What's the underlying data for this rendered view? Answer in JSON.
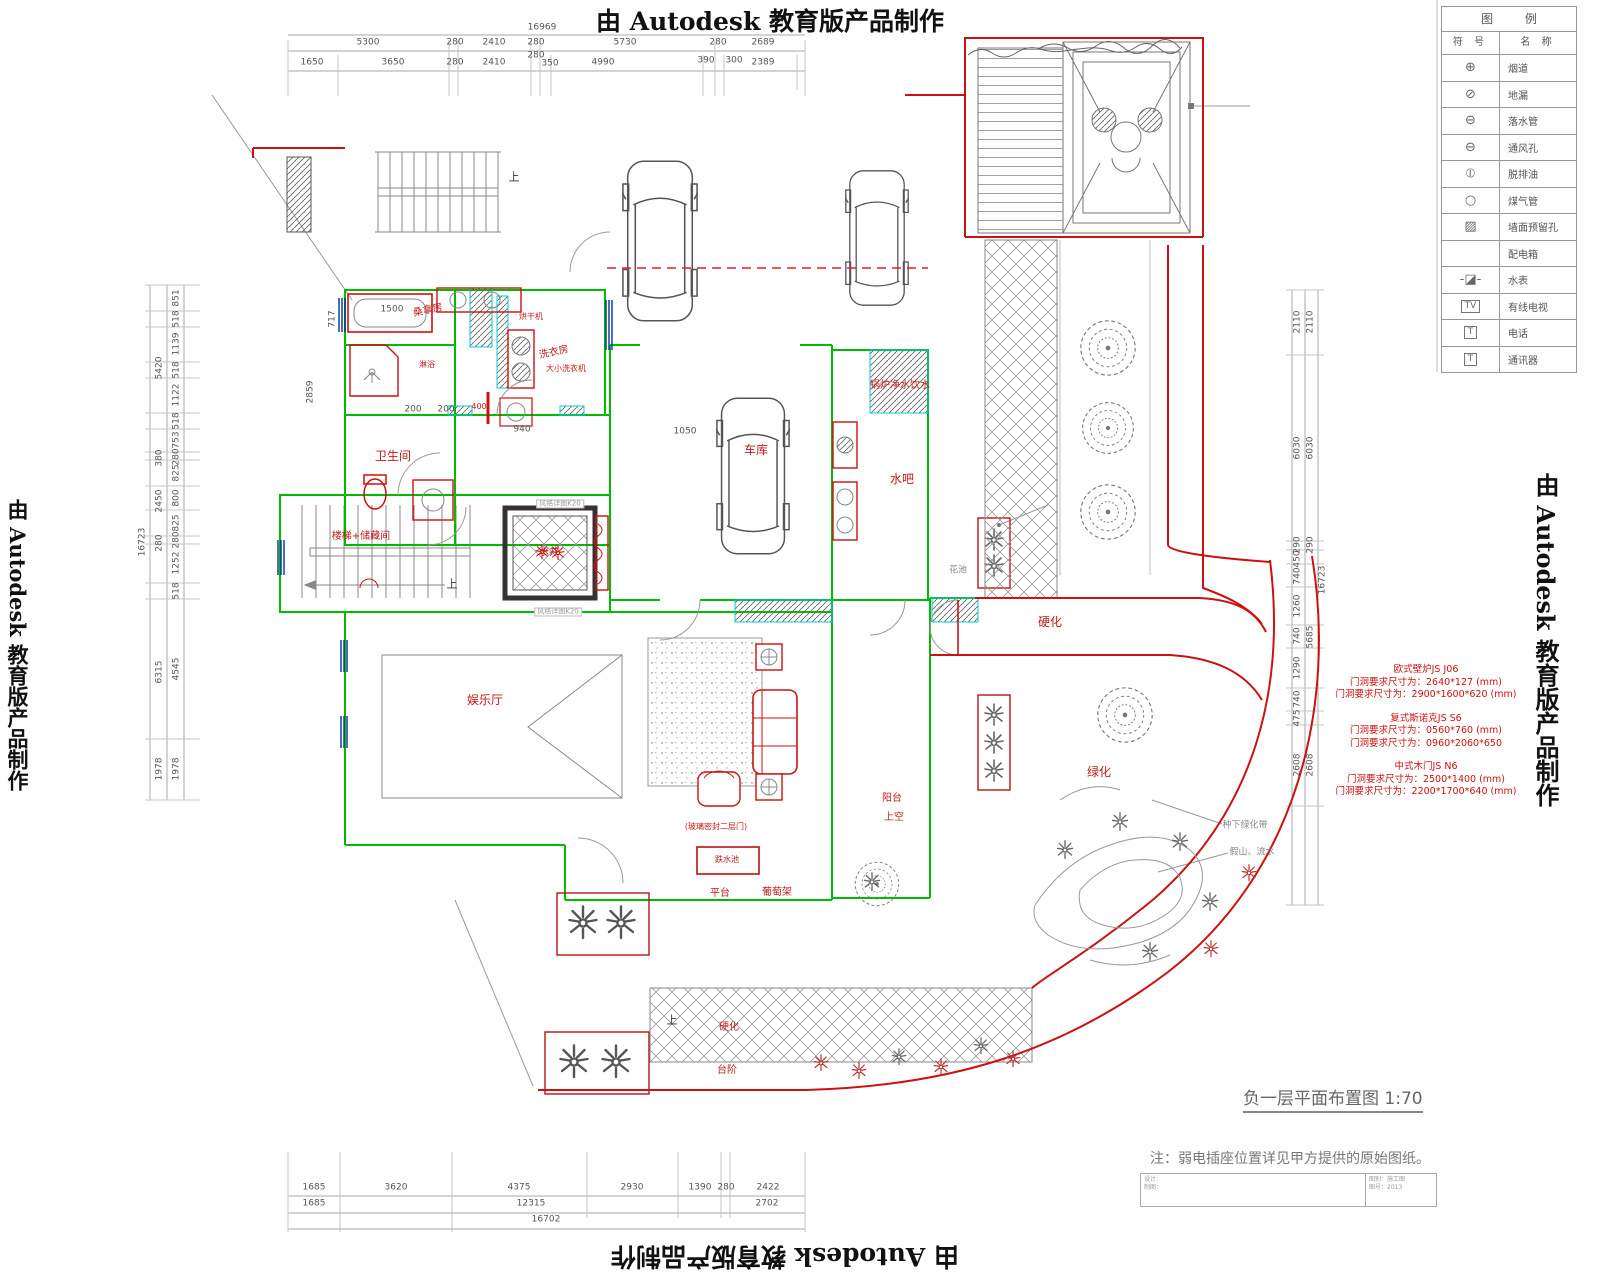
{
  "watermark": {
    "text": "由 Autodesk 教育版产品制作"
  },
  "title": {
    "text": "负一层平面布置图 1:70"
  },
  "note": {
    "text": "注：弱电插座位置详见甲方提供的原始图纸。"
  },
  "titleblock": {
    "left1": "设计：",
    "left2": "制图：",
    "right1": "图别：施工图",
    "right2": "图号：2013"
  },
  "legend": {
    "header": "图 例",
    "col_symbol": "符 号",
    "col_name": "名 称",
    "rows": [
      {
        "sym": "⊕",
        "name": "烟道",
        "box": false
      },
      {
        "sym": "⊘",
        "name": "地漏",
        "box": false
      },
      {
        "sym": "⊖",
        "name": "落水管",
        "box": false
      },
      {
        "sym": "⊖",
        "name": "通风孔",
        "box": false
      },
      {
        "sym": "⦶",
        "name": "脱排油",
        "box": false
      },
      {
        "sym": "○",
        "name": "煤气管",
        "box": false
      },
      {
        "sym": "▨",
        "name": "墙面预留孔",
        "box": false
      },
      {
        "sym": "",
        "name": "配电箱",
        "box": false
      },
      {
        "sym": "-◪-",
        "name": "水表",
        "box": false
      },
      {
        "sym": "TV",
        "name": "有线电视",
        "box": true
      },
      {
        "sym": "T",
        "name": "电话",
        "box": true
      },
      {
        "sym": "T",
        "name": "通讯器",
        "box": true
      }
    ]
  },
  "annotations": {
    "groups": [
      {
        "lines": [
          "欧式壁炉JS J06",
          "门洞要求尺寸为：2640*127 (mm)",
          "门洞要求尺寸为：2900*1600*620 (mm)"
        ]
      },
      {
        "lines": [
          "复式斯诺克JS S6",
          "门洞要求尺寸为：0560*760 (mm)",
          "门洞要求尺寸为：0960*2060*650"
        ]
      },
      {
        "lines": [
          "中式木门JS N6",
          "门洞要求尺寸为：2500*1400 (mm)",
          "门洞要求尺寸为：2200*1700*640 (mm)"
        ]
      }
    ]
  },
  "labels": [
    {
      "t": "16969",
      "x": 542,
      "y": 28,
      "c": "dim",
      "n": "dim-top-overall"
    },
    {
      "t": "5300",
      "x": 368,
      "y": 43,
      "c": "dim"
    },
    {
      "t": "280",
      "x": 455,
      "y": 43,
      "c": "dim"
    },
    {
      "t": "2410",
      "x": 494,
      "y": 43,
      "c": "dim"
    },
    {
      "t": "280",
      "x": 536,
      "y": 43,
      "c": "dim"
    },
    {
      "t": "5730",
      "x": 625,
      "y": 43,
      "c": "dim"
    },
    {
      "t": "280",
      "x": 718,
      "y": 43,
      "c": "dim"
    },
    {
      "t": "2689",
      "x": 763,
      "y": 43,
      "c": "dim"
    },
    {
      "t": "1650",
      "x": 312,
      "y": 63,
      "c": "dim"
    },
    {
      "t": "3650",
      "x": 393,
      "y": 63,
      "c": "dim"
    },
    {
      "t": "280",
      "x": 455,
      "y": 63,
      "c": "dim"
    },
    {
      "t": "2410",
      "x": 494,
      "y": 63,
      "c": "dim"
    },
    {
      "t": "280",
      "x": 536,
      "y": 56,
      "c": "dim"
    },
    {
      "t": "350",
      "x": 550,
      "y": 64,
      "c": "dim"
    },
    {
      "t": "4990",
      "x": 603,
      "y": 63,
      "c": "dim"
    },
    {
      "t": "390",
      "x": 706,
      "y": 61,
      "c": "dim"
    },
    {
      "t": "300",
      "x": 734,
      "y": 61,
      "c": "dim"
    },
    {
      "t": "2389",
      "x": 763,
      "y": 63,
      "c": "dim"
    },
    {
      "t": "1685",
      "x": 314,
      "y": 1188,
      "c": "dim"
    },
    {
      "t": "3620",
      "x": 396,
      "y": 1188,
      "c": "dim"
    },
    {
      "t": "4375",
      "x": 519,
      "y": 1188,
      "c": "dim"
    },
    {
      "t": "2930",
      "x": 632,
      "y": 1188,
      "c": "dim"
    },
    {
      "t": "1390",
      "x": 700,
      "y": 1188,
      "c": "dim"
    },
    {
      "t": "280",
      "x": 726,
      "y": 1188,
      "c": "dim"
    },
    {
      "t": "2422",
      "x": 768,
      "y": 1188,
      "c": "dim"
    },
    {
      "t": "1685",
      "x": 314,
      "y": 1204,
      "c": "dim"
    },
    {
      "t": "12315",
      "x": 531,
      "y": 1204,
      "c": "dim"
    },
    {
      "t": "2702",
      "x": 767,
      "y": 1204,
      "c": "dim"
    },
    {
      "t": "16702",
      "x": 546,
      "y": 1220,
      "c": "dim",
      "n": "dim-bottom-overall"
    },
    {
      "t": "851",
      "x": 177,
      "y": 298,
      "c": "dimv"
    },
    {
      "t": "518",
      "x": 177,
      "y": 319,
      "c": "dimv"
    },
    {
      "t": "1139",
      "x": 177,
      "y": 344,
      "c": "dimv"
    },
    {
      "t": "518",
      "x": 177,
      "y": 370,
      "c": "dimv"
    },
    {
      "t": "1122",
      "x": 177,
      "y": 395,
      "c": "dimv"
    },
    {
      "t": "518",
      "x": 177,
      "y": 421,
      "c": "dimv"
    },
    {
      "t": "753",
      "x": 177,
      "y": 440,
      "c": "dimv"
    },
    {
      "t": "280",
      "x": 177,
      "y": 457,
      "c": "dimv"
    },
    {
      "t": "825",
      "x": 177,
      "y": 473,
      "c": "dimv"
    },
    {
      "t": "800",
      "x": 177,
      "y": 498,
      "c": "dimv"
    },
    {
      "t": "825",
      "x": 177,
      "y": 523,
      "c": "dimv"
    },
    {
      "t": "280",
      "x": 177,
      "y": 540,
      "c": "dimv"
    },
    {
      "t": "1252",
      "x": 177,
      "y": 563,
      "c": "dimv"
    },
    {
      "t": "518",
      "x": 177,
      "y": 591,
      "c": "dimv"
    },
    {
      "t": "4545",
      "x": 177,
      "y": 669,
      "c": "dimv"
    },
    {
      "t": "1978",
      "x": 177,
      "y": 769,
      "c": "dimv"
    },
    {
      "t": "5420",
      "x": 160,
      "y": 368,
      "c": "dimv"
    },
    {
      "t": "380",
      "x": 160,
      "y": 458,
      "c": "dimv"
    },
    {
      "t": "2450",
      "x": 160,
      "y": 501,
      "c": "dimv"
    },
    {
      "t": "280",
      "x": 160,
      "y": 543,
      "c": "dimv"
    },
    {
      "t": "6315",
      "x": 160,
      "y": 672,
      "c": "dimv"
    },
    {
      "t": "1978",
      "x": 160,
      "y": 769,
      "c": "dimv"
    },
    {
      "t": "16723",
      "x": 143,
      "y": 542,
      "c": "dimv",
      "n": "dim-left-overall"
    },
    {
      "t": "2110",
      "x": 1298,
      "y": 322,
      "c": "dimv"
    },
    {
      "t": "6030",
      "x": 1298,
      "y": 448,
      "c": "dimv"
    },
    {
      "t": "290",
      "x": 1298,
      "y": 545,
      "c": "dimv"
    },
    {
      "t": "450",
      "x": 1298,
      "y": 559,
      "c": "dimv"
    },
    {
      "t": "740",
      "x": 1298,
      "y": 576,
      "c": "dimv"
    },
    {
      "t": "1260",
      "x": 1298,
      "y": 606,
      "c": "dimv"
    },
    {
      "t": "740",
      "x": 1298,
      "y": 636,
      "c": "dimv"
    },
    {
      "t": "1290",
      "x": 1298,
      "y": 668,
      "c": "dimv"
    },
    {
      "t": "740",
      "x": 1298,
      "y": 699,
      "c": "dimv"
    },
    {
      "t": "475",
      "x": 1298,
      "y": 718,
      "c": "dimv"
    },
    {
      "t": "2608",
      "x": 1298,
      "y": 765,
      "c": "dimv"
    },
    {
      "t": "2110",
      "x": 1311,
      "y": 322,
      "c": "dimv"
    },
    {
      "t": "6030",
      "x": 1311,
      "y": 448,
      "c": "dimv"
    },
    {
      "t": "290",
      "x": 1311,
      "y": 545,
      "c": "dimv"
    },
    {
      "t": "5685",
      "x": 1311,
      "y": 637,
      "c": "dimv"
    },
    {
      "t": "2608",
      "x": 1311,
      "y": 765,
      "c": "dimv"
    },
    {
      "t": "16723",
      "x": 1323,
      "y": 580,
      "c": "dimv",
      "n": "dim-right-overall"
    },
    {
      "t": "1500",
      "x": 392,
      "y": 310,
      "c": "dim"
    },
    {
      "t": "200",
      "x": 413,
      "y": 410,
      "c": "dim"
    },
    {
      "t": "200",
      "x": 446,
      "y": 410,
      "c": "dim"
    },
    {
      "t": "940",
      "x": 522,
      "y": 430,
      "c": "dim"
    },
    {
      "t": "1050",
      "x": 685,
      "y": 432,
      "c": "dim"
    },
    {
      "t": "2859",
      "x": 311,
      "y": 392,
      "c": "dimv"
    },
    {
      "t": "717",
      "x": 333,
      "y": 319,
      "c": "dimv"
    },
    {
      "t": "400",
      "x": 479,
      "y": 407,
      "c": "redtiny"
    },
    {
      "t": "桑拿房",
      "x": 428,
      "y": 311,
      "c": "redsm",
      "r": -12,
      "n": "room-label-sauna"
    },
    {
      "t": "烘干机",
      "x": 531,
      "y": 317,
      "c": "redtiny",
      "n": "room-label-dryer"
    },
    {
      "t": "淋浴",
      "x": 427,
      "y": 365,
      "c": "redtiny",
      "n": "room-label-shower"
    },
    {
      "t": "洗衣房",
      "x": 554,
      "y": 353,
      "c": "redsm",
      "r": -12,
      "n": "room-label-laundry"
    },
    {
      "t": "大小洗衣机",
      "x": 566,
      "y": 369,
      "c": "redtiny",
      "n": "room-label-washers"
    },
    {
      "t": "卫生间",
      "x": 393,
      "y": 456,
      "c": "red",
      "n": "room-label-bathroom"
    },
    {
      "t": "楼梯+储藏间",
      "x": 361,
      "y": 537,
      "c": "redsm",
      "n": "room-label-stairs-storage"
    },
    {
      "t": "水井",
      "x": 549,
      "y": 553,
      "c": "redsm",
      "n": "room-label-well"
    },
    {
      "t": "车库",
      "x": 756,
      "y": 450,
      "c": "red",
      "n": "room-label-garage"
    },
    {
      "t": "锅炉净水饮水",
      "x": 900,
      "y": 386,
      "c": "redsm",
      "n": "room-label-boiler"
    },
    {
      "t": "水吧",
      "x": 902,
      "y": 479,
      "c": "red",
      "n": "room-label-water-bar"
    },
    {
      "t": "硬化",
      "x": 1050,
      "y": 622,
      "c": "red",
      "n": "area-label-paving-1"
    },
    {
      "t": "绿化",
      "x": 1099,
      "y": 772,
      "c": "red",
      "n": "area-label-greenery"
    },
    {
      "t": "娱乐厅",
      "x": 485,
      "y": 700,
      "c": "red",
      "n": "room-label-recreation"
    },
    {
      "t": "(玻璃密封二层门)",
      "x": 716,
      "y": 827,
      "c": "redtiny",
      "n": "note-glass-door"
    },
    {
      "t": "跌水池",
      "x": 727,
      "y": 860,
      "c": "redtiny",
      "n": "label-water-feature"
    },
    {
      "t": "阳台",
      "x": 892,
      "y": 799,
      "c": "redsm",
      "n": "label-balcony"
    },
    {
      "t": "上空",
      "x": 894,
      "y": 818,
      "c": "redsm",
      "n": "label-open-above"
    },
    {
      "t": "平台",
      "x": 720,
      "y": 894,
      "c": "redsm",
      "n": "label-platform"
    },
    {
      "t": "葡萄架",
      "x": 777,
      "y": 893,
      "c": "redsm",
      "n": "label-trellis"
    },
    {
      "t": "硬化",
      "x": 729,
      "y": 1028,
      "c": "redsm",
      "n": "area-label-paving-2"
    },
    {
      "t": "台阶",
      "x": 727,
      "y": 1071,
      "c": "redsm",
      "n": "label-steps"
    },
    {
      "t": "上",
      "x": 514,
      "y": 177,
      "c": "blk",
      "n": "stair-up-1"
    },
    {
      "t": "上",
      "x": 452,
      "y": 584,
      "c": "blk",
      "n": "stair-up-2"
    },
    {
      "t": "上",
      "x": 672,
      "y": 1020,
      "c": "blk",
      "n": "stair-up-3"
    },
    {
      "t": "花池",
      "x": 958,
      "y": 571,
      "c": "gry",
      "n": "label-planter"
    },
    {
      "t": "种下绿化带",
      "x": 1245,
      "y": 826,
      "c": "gry",
      "n": "label-planting-strip"
    },
    {
      "t": "假山、流水",
      "x": 1252,
      "y": 853,
      "c": "gry",
      "n": "label-rockery-water"
    },
    {
      "t": "风格详图K20",
      "x": 560,
      "y": 504,
      "c": "tinybox",
      "n": "tag-detail-1"
    },
    {
      "t": "风格详图K20",
      "x": 558,
      "y": 612,
      "c": "tinybox",
      "n": "tag-detail-2"
    }
  ]
}
